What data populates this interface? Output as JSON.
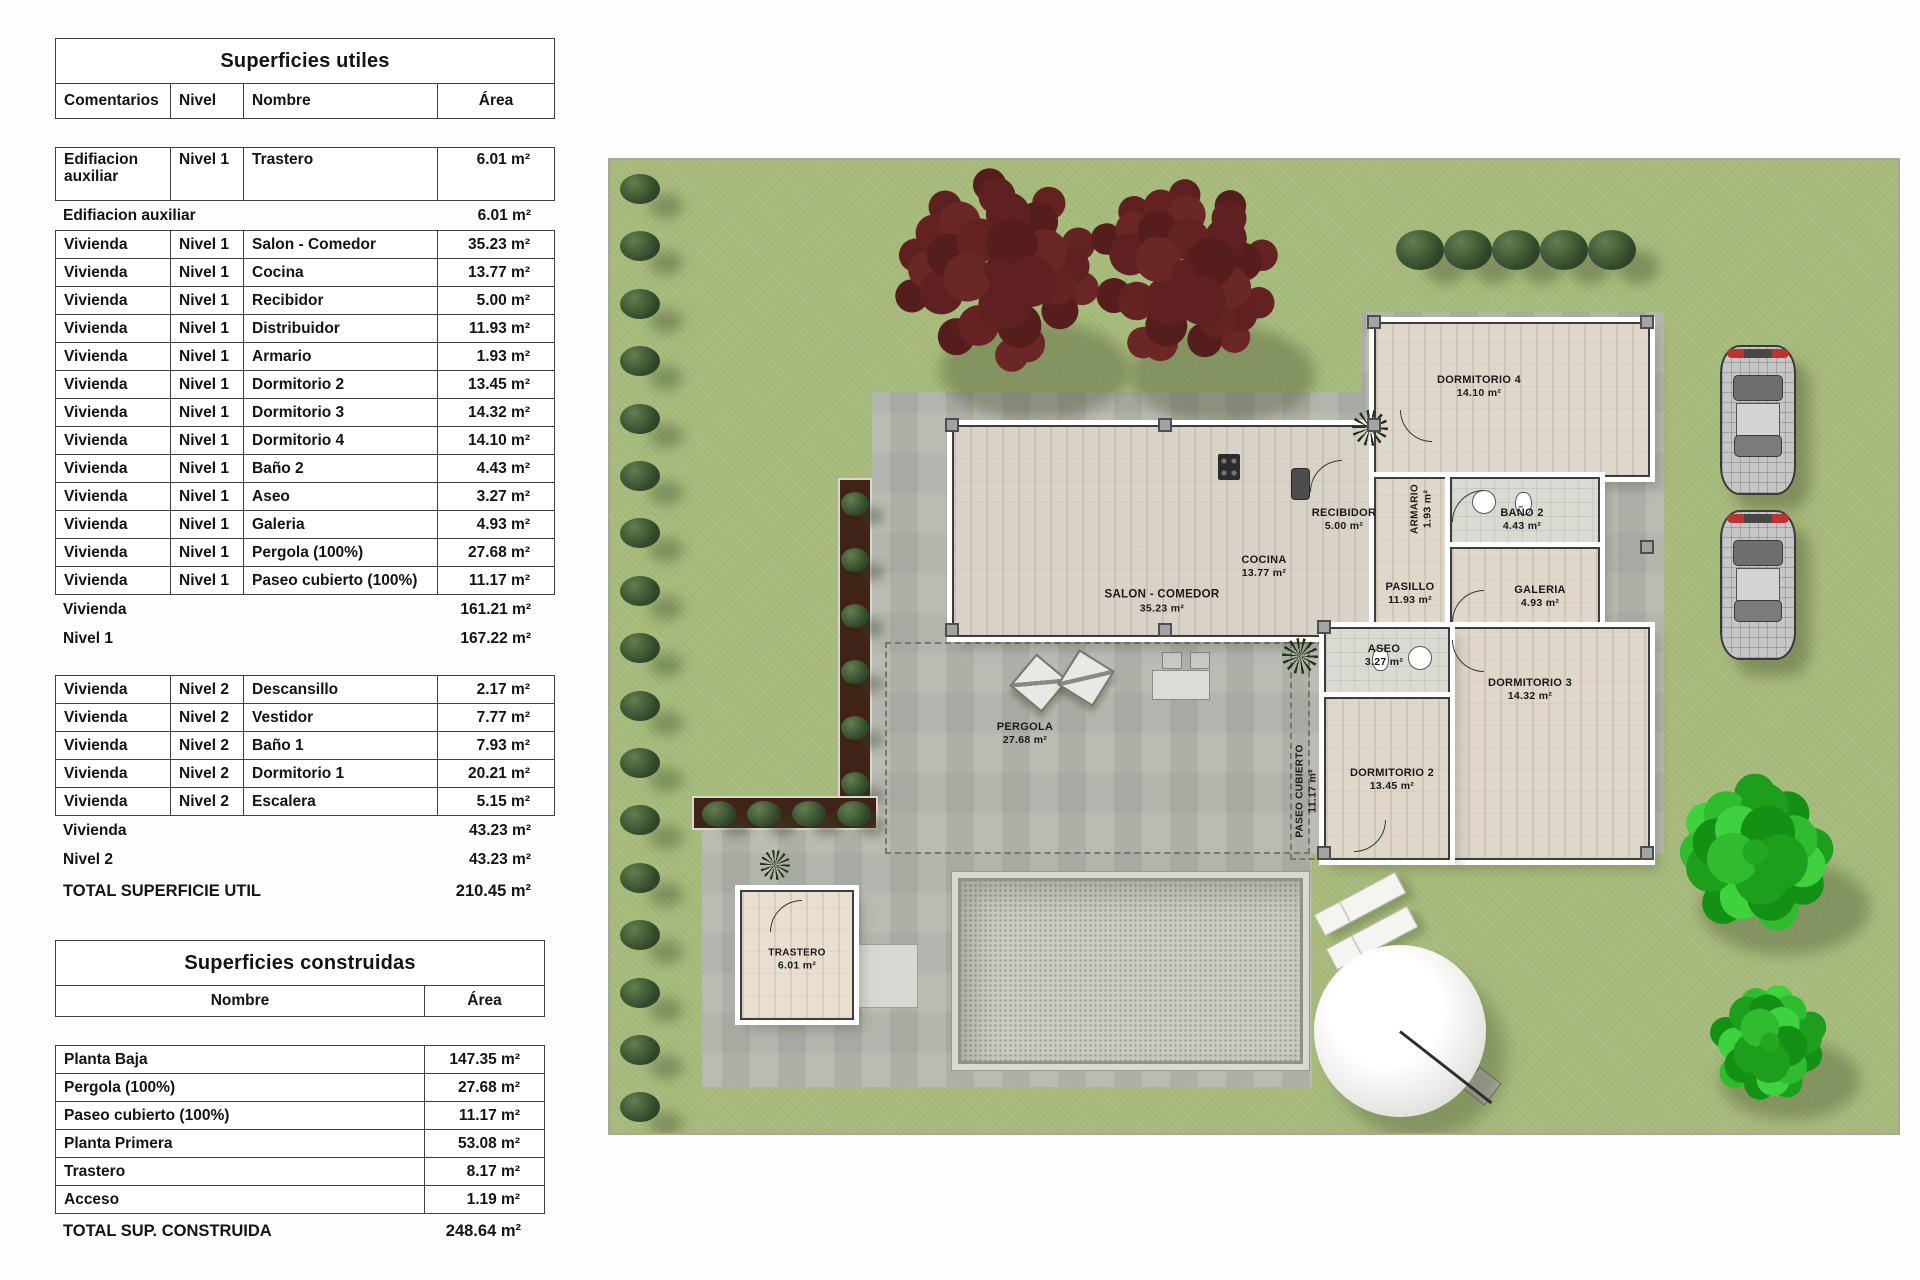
{
  "superficies_utiles": {
    "title": "Superficies utiles",
    "headers": {
      "comentarios": "Comentarios",
      "nivel": "Nivel",
      "nombre": "Nombre",
      "area": "Área"
    },
    "col_keys": [
      "comentarios",
      "nivel",
      "nombre",
      "area"
    ],
    "rows": [
      {
        "type": "data",
        "tall": true,
        "comentarios": "Edifiacion auxiliar",
        "nivel": "Nivel 1",
        "nombre": "Trastero",
        "area": "6.01 m²"
      },
      {
        "type": "summary",
        "label": "Edifiacion auxiliar",
        "area": "6.01 m²"
      },
      {
        "type": "data",
        "comentarios": "Vivienda",
        "nivel": "Nivel 1",
        "nombre": "Salon - Comedor",
        "area": "35.23 m²"
      },
      {
        "type": "data",
        "comentarios": "Vivienda",
        "nivel": "Nivel 1",
        "nombre": "Cocina",
        "area": "13.77 m²"
      },
      {
        "type": "data",
        "comentarios": "Vivienda",
        "nivel": "Nivel 1",
        "nombre": "Recibidor",
        "area": "5.00 m²"
      },
      {
        "type": "data",
        "comentarios": "Vivienda",
        "nivel": "Nivel 1",
        "nombre": "Distribuidor",
        "area": "11.93 m²"
      },
      {
        "type": "data",
        "comentarios": "Vivienda",
        "nivel": "Nivel 1",
        "nombre": "Armario",
        "area": "1.93 m²"
      },
      {
        "type": "data",
        "comentarios": "Vivienda",
        "nivel": "Nivel 1",
        "nombre": "Dormitorio 2",
        "area": "13.45 m²"
      },
      {
        "type": "data",
        "comentarios": "Vivienda",
        "nivel": "Nivel 1",
        "nombre": "Dormitorio 3",
        "area": "14.32 m²"
      },
      {
        "type": "data",
        "comentarios": "Vivienda",
        "nivel": "Nivel 1",
        "nombre": "Dormitorio 4",
        "area": "14.10 m²"
      },
      {
        "type": "data",
        "comentarios": "Vivienda",
        "nivel": "Nivel 1",
        "nombre": "Baño 2",
        "area": "4.43 m²"
      },
      {
        "type": "data",
        "comentarios": "Vivienda",
        "nivel": "Nivel 1",
        "nombre": "Aseo",
        "area": "3.27 m²"
      },
      {
        "type": "data",
        "comentarios": "Vivienda",
        "nivel": "Nivel 1",
        "nombre": "Galeria",
        "area": "4.93 m²"
      },
      {
        "type": "data",
        "comentarios": "Vivienda",
        "nivel": "Nivel 1",
        "nombre": "Pergola (100%)",
        "area": "27.68 m²"
      },
      {
        "type": "data",
        "comentarios": "Vivienda",
        "nivel": "Nivel 1",
        "nombre": "Paseo cubierto (100%)",
        "area": "11.17 m²"
      },
      {
        "type": "summary",
        "label": "Vivienda",
        "area": "161.21 m²"
      },
      {
        "type": "summary",
        "label": "Nivel 1",
        "area": "167.22 m²"
      },
      {
        "type": "data",
        "gap_before": true,
        "comentarios": "Vivienda",
        "nivel": "Nivel 2",
        "nombre": "Descansillo",
        "area": "2.17 m²"
      },
      {
        "type": "data",
        "comentarios": "Vivienda",
        "nivel": "Nivel 2",
        "nombre": "Vestidor",
        "area": "7.77 m²"
      },
      {
        "type": "data",
        "comentarios": "Vivienda",
        "nivel": "Nivel 2",
        "nombre": "Baño 1",
        "area": "7.93 m²"
      },
      {
        "type": "data",
        "comentarios": "Vivienda",
        "nivel": "Nivel 2",
        "nombre": "Dormitorio 1",
        "area": "20.21 m²"
      },
      {
        "type": "data",
        "comentarios": "Vivienda",
        "nivel": "Nivel 2",
        "nombre": "Escalera",
        "area": "5.15 m²"
      },
      {
        "type": "summary",
        "label": "Vivienda",
        "area": "43.23 m²"
      },
      {
        "type": "summary",
        "label": "Nivel 2",
        "area": "43.23 m²"
      },
      {
        "type": "total",
        "label": "TOTAL SUPERFICIE UTIL",
        "area": "210.45 m²"
      }
    ]
  },
  "superficies_construidas": {
    "title": "Superficies construidas",
    "headers": {
      "nombre": "Nombre",
      "area": "Área"
    },
    "col_keys": [
      "nombre",
      "area"
    ],
    "rows": [
      {
        "type": "data",
        "nombre": "Planta Baja",
        "area": "147.35 m²"
      },
      {
        "type": "data",
        "nombre": "Pergola (100%)",
        "area": "27.68 m²"
      },
      {
        "type": "data",
        "nombre": "Paseo cubierto (100%)",
        "area": "11.17 m²"
      },
      {
        "type": "data",
        "nombre": "Planta Primera",
        "area": "53.08 m²"
      },
      {
        "type": "data",
        "nombre": "Trastero",
        "area": "8.17 m²"
      },
      {
        "type": "data",
        "nombre": "Acceso",
        "area": "1.19 m²"
      },
      {
        "type": "total",
        "label": "TOTAL SUP. CONSTRUIDA",
        "area": "248.64 m²"
      }
    ]
  },
  "plan": {
    "labels": {
      "salon": {
        "name": "SALON - COMEDOR",
        "area": "35.23 m²"
      },
      "cocina": {
        "name": "COCINA",
        "area": "13.77 m²"
      },
      "recibidor": {
        "name": "RECIBIDOR",
        "area": "5.00 m²"
      },
      "armario": {
        "name": "ARMARIO",
        "area": "1.93 m²"
      },
      "pasillo": {
        "name": "PASILLO",
        "area": "11.93 m²"
      },
      "bano2": {
        "name": "BAÑO 2",
        "area": "4.43 m²"
      },
      "galeria": {
        "name": "GALERIA",
        "area": "4.93 m²"
      },
      "dormitorio4": {
        "name": "DORMITORIO 4",
        "area": "14.10 m²"
      },
      "dormitorio3": {
        "name": "DORMITORIO 3",
        "area": "14.32 m²"
      },
      "dormitorio2": {
        "name": "DORMITORIO 2",
        "area": "13.45 m²"
      },
      "aseo": {
        "name": "ASEO",
        "area": "3.27 m²"
      },
      "pergola": {
        "name": "PERGOLA",
        "area": "27.68 m²"
      },
      "paseo": {
        "name": "PASEO CUBIERTO",
        "area": "11.17 m²"
      },
      "trastero": {
        "name": "TRASTERO",
        "area": "6.01 m²"
      }
    }
  },
  "colors": {
    "lawn": "#a6bb7b",
    "pavement": "#b6b9b0",
    "wood_floor": "#dfd7ca",
    "wall_white": "#ffffff",
    "red_tree": "#5e2020",
    "green_tree": "#1d9e1d",
    "bush_dark": "#31492b",
    "pool": "#caccc1",
    "car_tail_red": "#bb3333"
  }
}
